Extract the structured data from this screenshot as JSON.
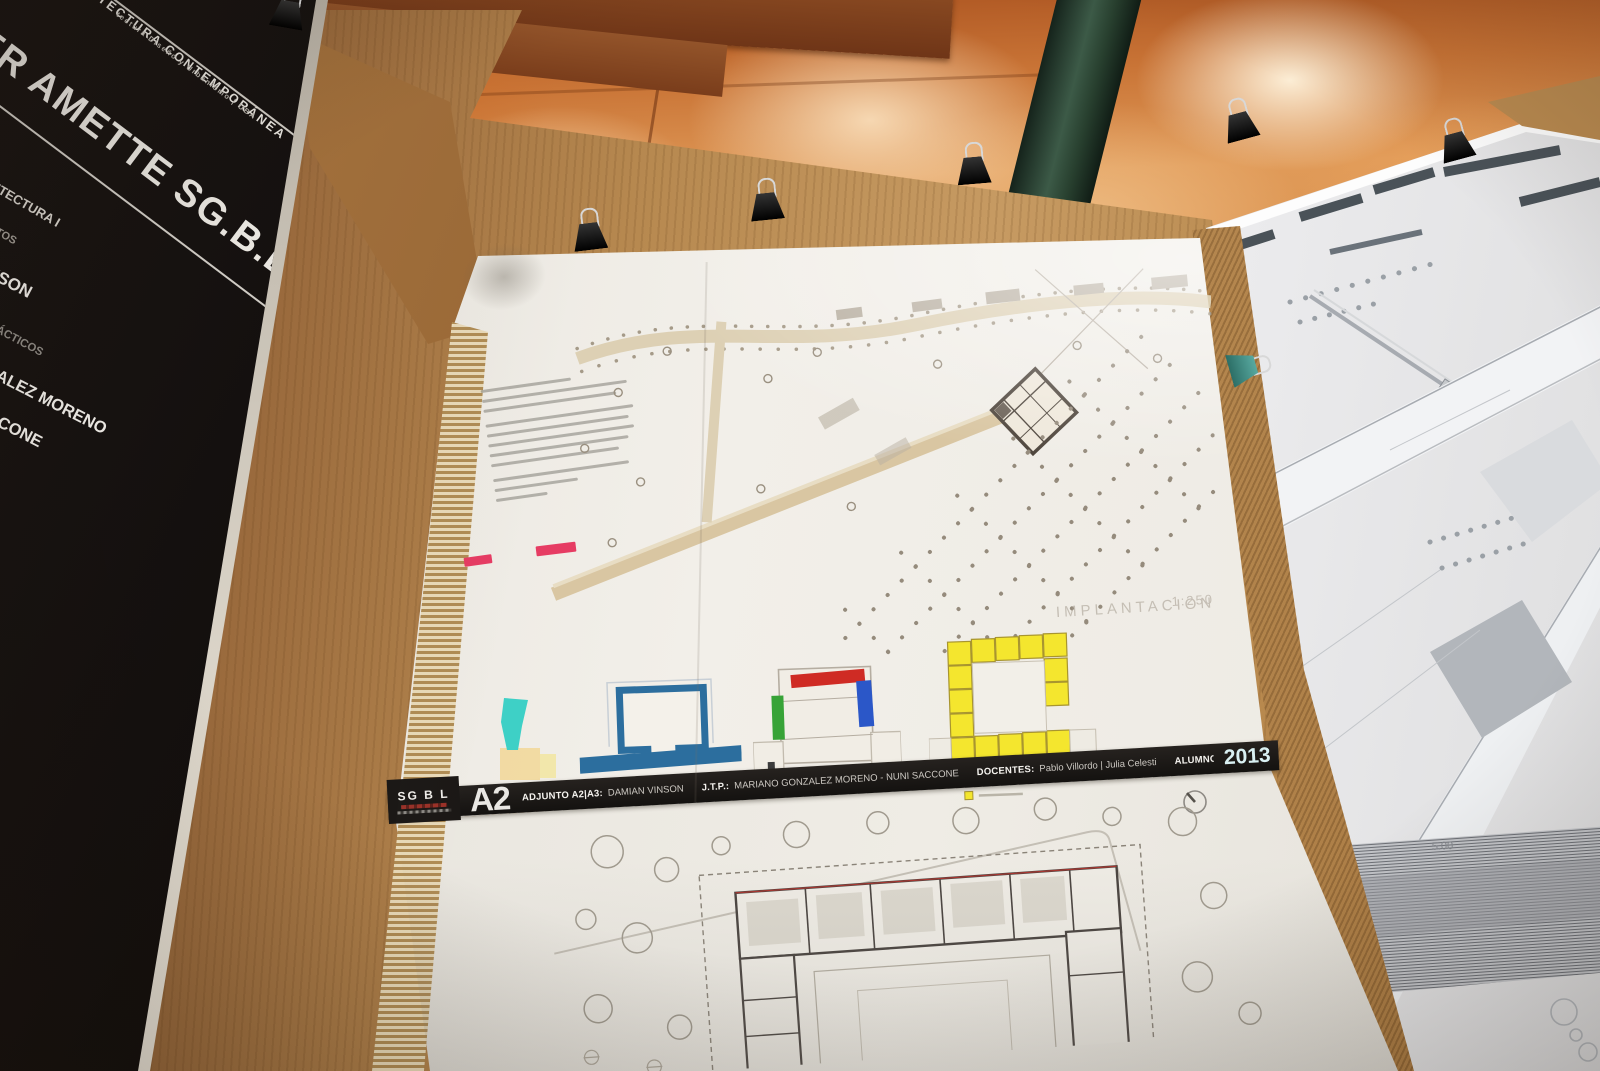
{
  "scene": {
    "description": "Photograph of an architecture studio exhibition: student presentation sheets binder-clipped to cardboard panels in front of a backlit orange screen"
  },
  "left_panel": {
    "heading": "TECTURA CONTEMPORÁNEA",
    "subheading": "tectura Diseño y Urbanismo | UBA",
    "title": "ER AMETTE SG.B.L",
    "items": [
      {
        "label": "UITECTURA I"
      },
      {
        "label": "NTOS"
      },
      {
        "label": "NSON"
      },
      {
        "label": "RÁCTICOS"
      },
      {
        "label": "ZALEZ MORENO"
      },
      {
        "label": "CCONE"
      }
    ]
  },
  "banner": {
    "logo": "SG B L",
    "sheet_code": "A2",
    "adjunto_label": "ADJUNTO A2|A3:",
    "adjunto_name": "DAMIAN VINSON",
    "jtp_label": "J.T.P.:",
    "jtp_names": "MARIANO GONZALEZ MORENO - NUNI SACCONE",
    "docentes_label": "DOCENTES:",
    "docentes_names": "Pablo Villordo | Julia Celesti",
    "alumnos_label": "ALUMNOS:",
    "alumnos_names": "Acuña Victoria | Rocca Fiorella",
    "year": "2013"
  },
  "site_plan": {
    "label": "IMPLANTACION",
    "scale": "1:250"
  },
  "right_sheet": {
    "dimension": "5.00"
  },
  "palette": {
    "swatch_pink": "#e63c63",
    "cone_cyan": "#3ed0c6",
    "diagram_blue": "#2c6e9e",
    "diagram_red": "#cf2b24",
    "diagram_green": "#37a337",
    "diagram_blue2": "#2b57c8",
    "diagram_yellow": "#f4e62e",
    "year_color": "#d9f0f2",
    "backdrop_orange": "#d8924f",
    "cardboard_tan": "#b78950"
  }
}
